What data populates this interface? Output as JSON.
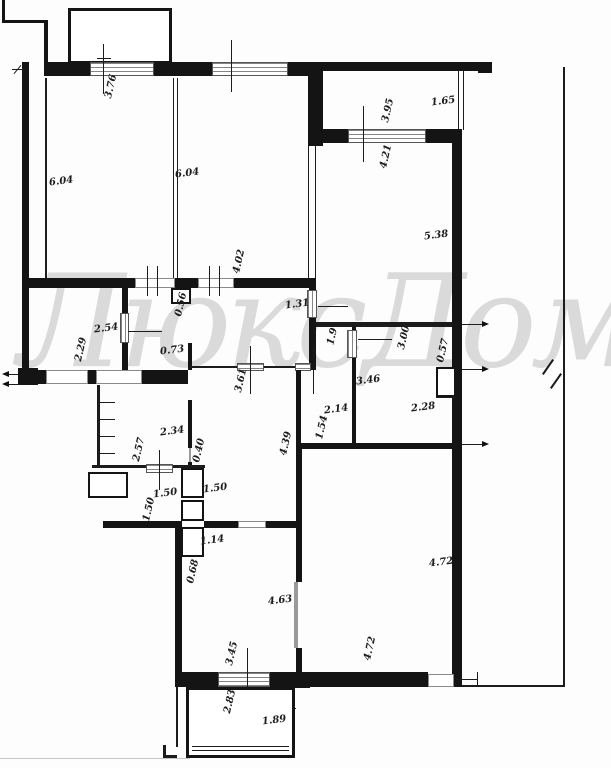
{
  "watermark": {
    "text": "ЛюксДом"
  },
  "dims": [
    "3.76",
    "6.04",
    "6.04",
    "4.02",
    "3.95",
    "4.21",
    "1.65",
    "5.38",
    "1.31",
    "2.54",
    "0.56",
    "2.29",
    "0.73",
    "1.9",
    "3.00",
    "0.57",
    "3.46",
    "2.28",
    "2.14",
    "1.54",
    "4.39",
    "3.61",
    "2.34",
    "2.57",
    "0.40",
    "1.50",
    "1.50",
    "1.50",
    "1.14",
    "0.68",
    "4.63",
    "4.72",
    "4.72",
    "3.45",
    "2.83",
    "1.89"
  ]
}
